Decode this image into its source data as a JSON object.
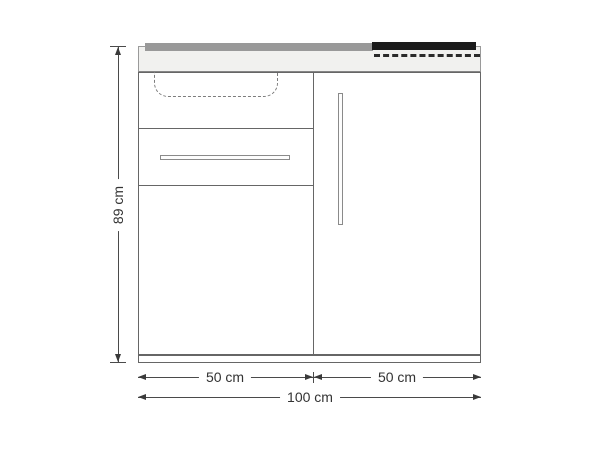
{
  "drawing": {
    "kind": "kitchen-unit-front-elevation",
    "dimensions": {
      "height": "89 cm",
      "left_width": "50 cm",
      "right_width": "50 cm",
      "total_width": "100 cm"
    },
    "colors": {
      "background": "#ffffff",
      "outline": "#666666",
      "counter_fill": "#f1f1ef",
      "counter_edge": "#9a9a9a",
      "cooktop": "#1b1b1b",
      "dimension_line": "#4a4a4a",
      "label_text": "#333333"
    },
    "parts": [
      "countertop",
      "sink-outline",
      "cooktop",
      "sink-front-panel",
      "drawer",
      "drawer-handle",
      "left-door",
      "right-door",
      "right-door-handle",
      "plinth"
    ]
  }
}
